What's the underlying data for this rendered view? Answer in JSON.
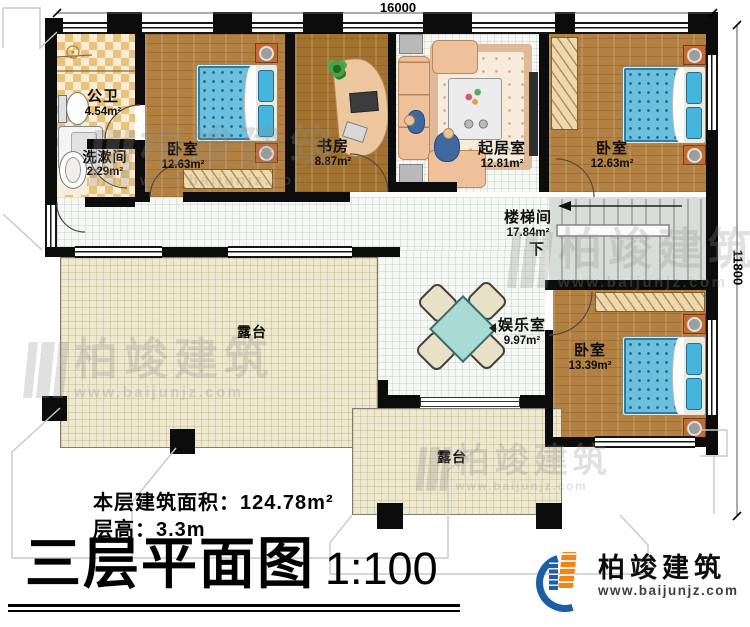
{
  "dimensions": {
    "width": "16000",
    "height": "11800"
  },
  "rooms": [
    {
      "name": "公卫",
      "area": "4.54m²"
    },
    {
      "name": "洗漱间",
      "area": "2.29m²"
    },
    {
      "name": "卧室",
      "area": "12.63m²"
    },
    {
      "name": "书房",
      "area": "8.87m²"
    },
    {
      "name": "起居室",
      "area": "12.81m²"
    },
    {
      "name": "卧室",
      "area": "12.63m²"
    },
    {
      "name": "楼梯间",
      "area": "17.84m²"
    },
    {
      "name": "娱乐室",
      "area": "9.97m²"
    },
    {
      "name": "卧室",
      "area": "13.39m²"
    }
  ],
  "terraces": [
    {
      "name": "露台"
    },
    {
      "name": "露台"
    }
  ],
  "stairs": {
    "down_label": "下"
  },
  "info": {
    "area_label": "本层建筑面积：",
    "area_value": "124.78m²",
    "height_line": "层高：3.3m"
  },
  "title": {
    "main": "三层平面图",
    "scale": "1:100"
  },
  "logo": {
    "company": "柏竣建筑",
    "website": "www.baijunjz.com"
  },
  "watermark": {
    "text": "柏竣建筑",
    "url": "www.baijunjz.com"
  },
  "colors": {
    "wall": "#0c0c0c",
    "wood": "#b28040",
    "tile": "#eac07b",
    "terrace": "#eee8cf",
    "mattress": "#6cc0dd",
    "logo_blue": "#1b5ea6",
    "logo_orange": "#f08519"
  }
}
